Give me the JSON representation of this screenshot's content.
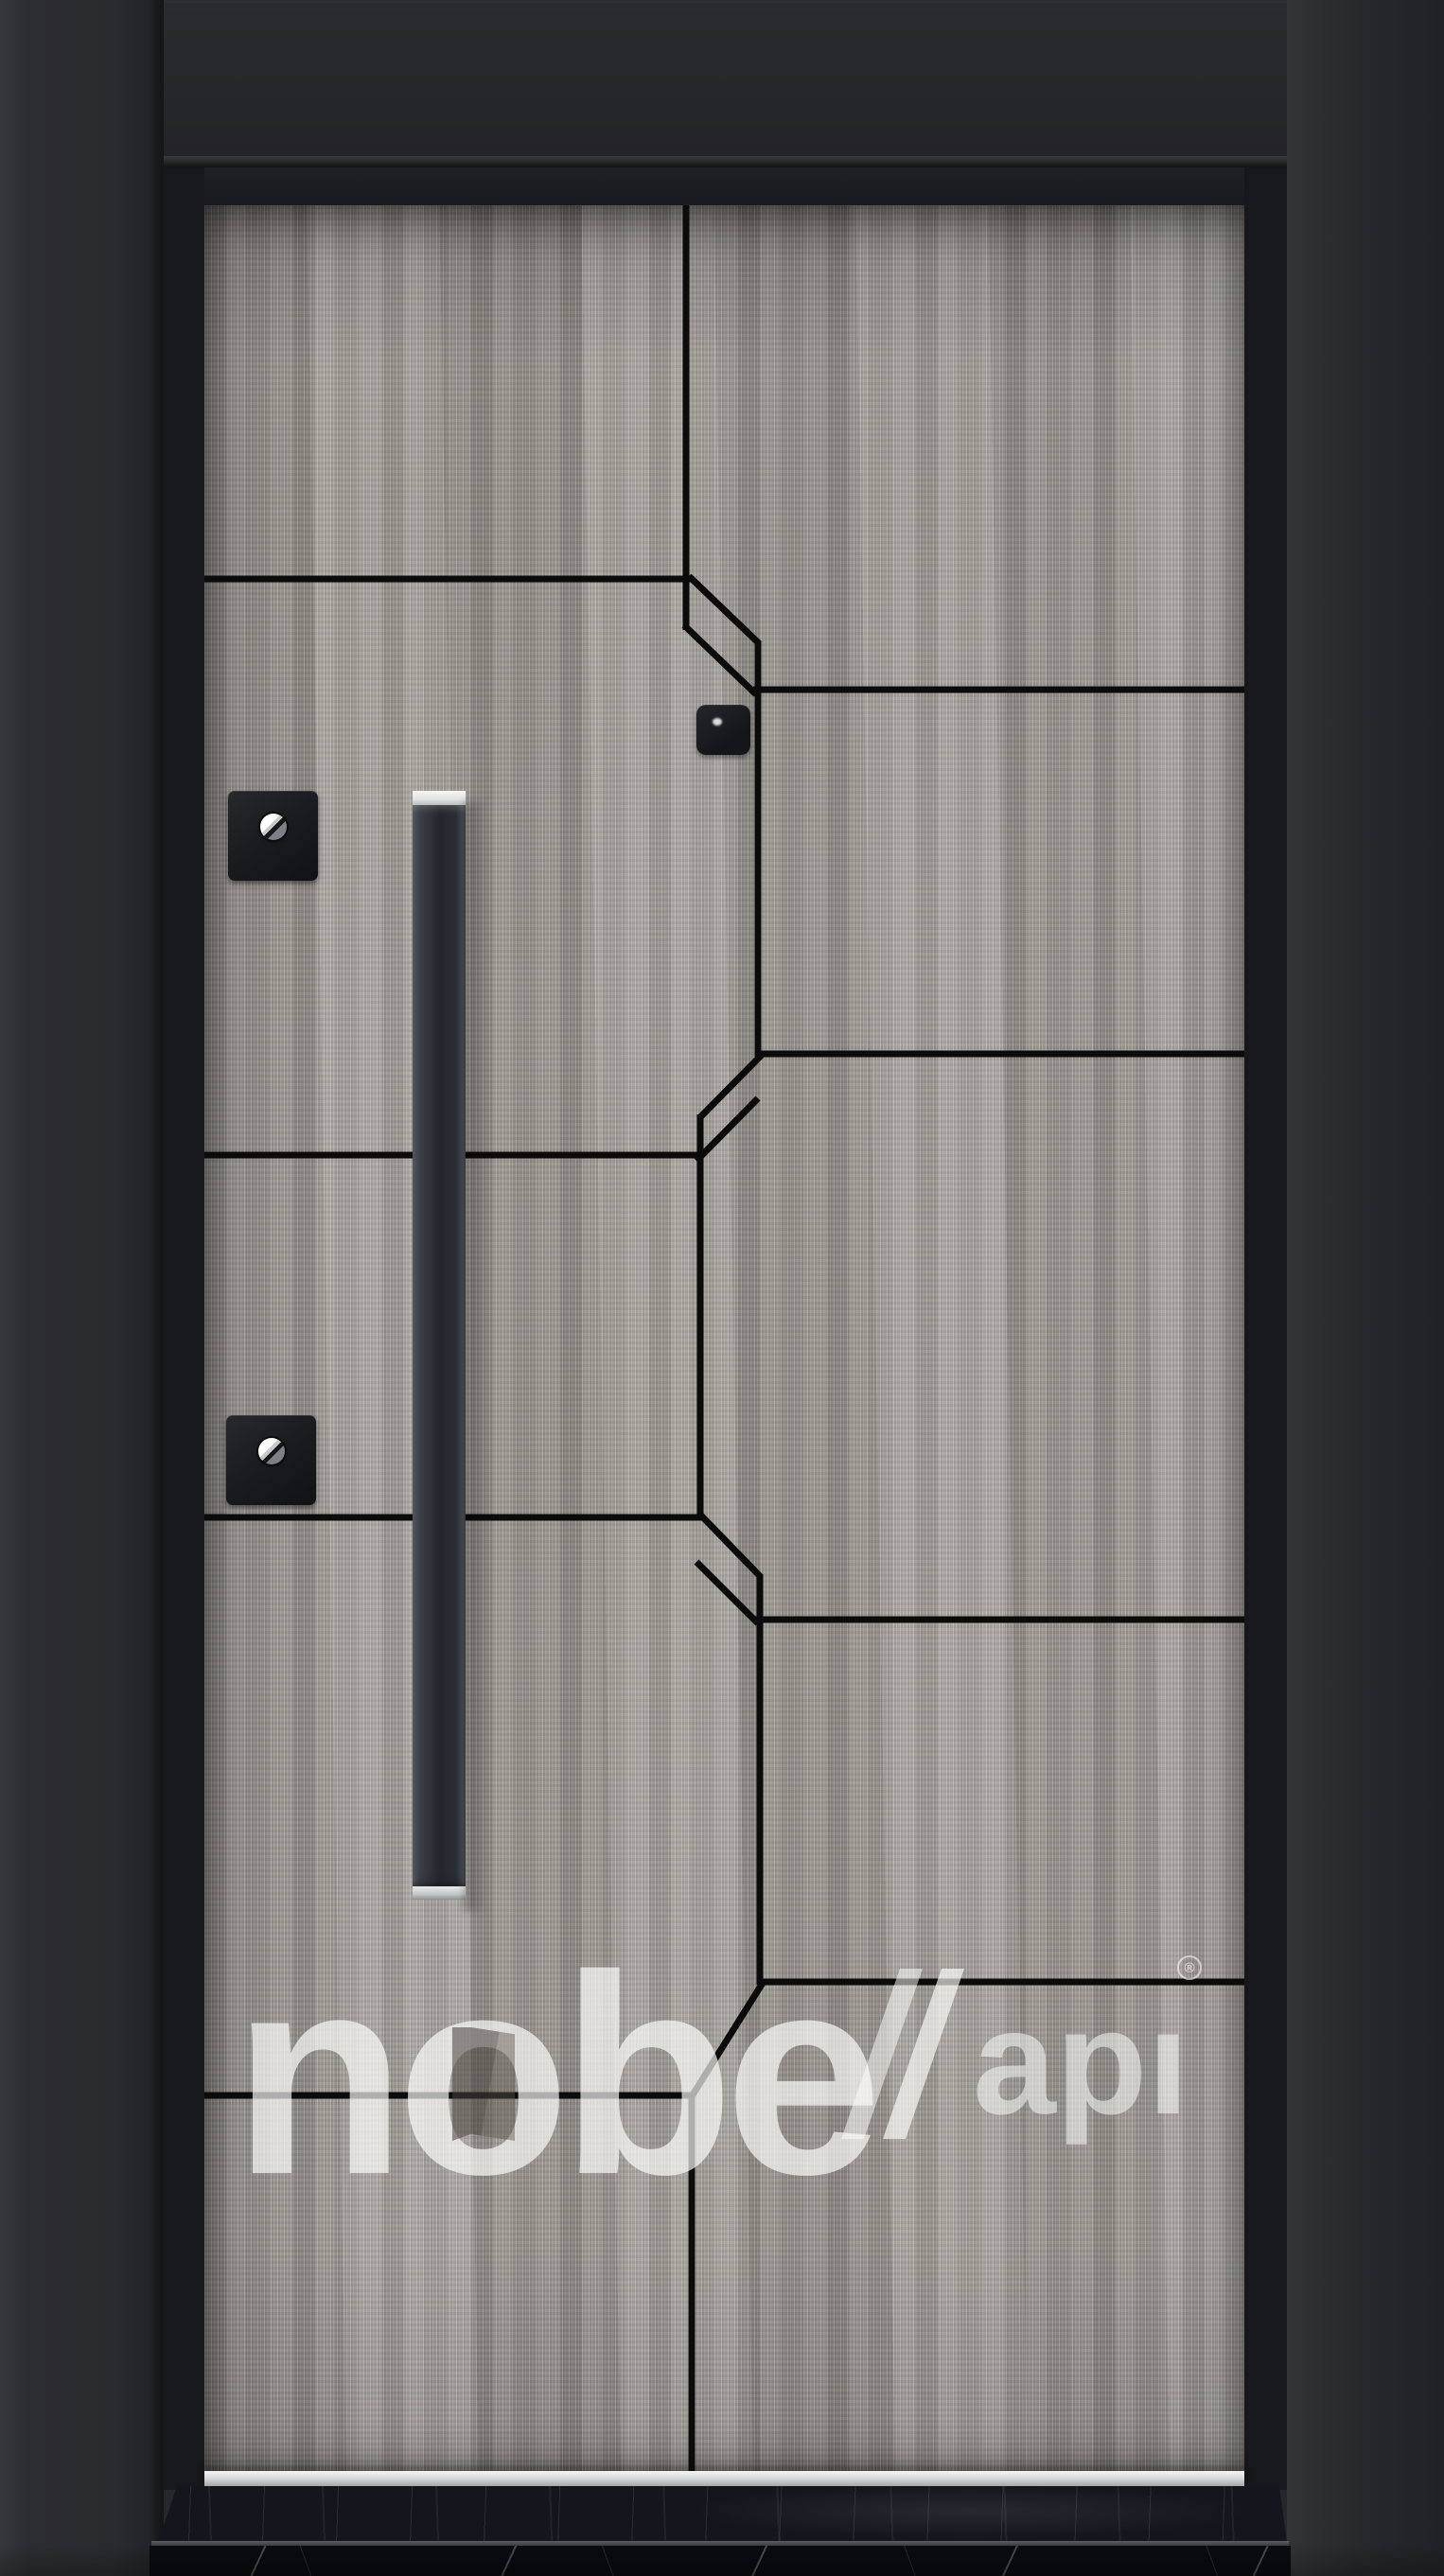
{
  "photo": {
    "subject": "Steel entry door product photo: grey wood-grain laminated leaf with black geometric groove lines, long black square pull handle, black frame with transom panel and black marble threshold",
    "watermark": {
      "full_brand": "nobel kapı",
      "primary_display": "nobe",
      "secondary_display": "apı",
      "registered": "®"
    },
    "hardware": [
      {
        "name": "vertical-pull-handle",
        "finish": "matte black with chrome end caps"
      },
      {
        "name": "upper-thumbturn-escutcheon",
        "finish": "matte black square, chrome turn"
      },
      {
        "name": "lower-thumbturn-escutcheon",
        "finish": "matte black square, chrome turn"
      },
      {
        "name": "cylinder-viewer",
        "finish": "black square with chrome lens"
      },
      {
        "name": "kick-plate",
        "finish": "brushed aluminum strip"
      }
    ],
    "colors": {
      "wood_base": "#a6a29c",
      "groove": "#0b0b0c",
      "frame_wall_left": "#2c2d30",
      "frame_wall_right": "#26272a",
      "transom": "#27282b",
      "jamb": "#17181b",
      "handle_body": "#2e3338",
      "chrome": "#e9eaea",
      "kick_strip": "#d9dbdb",
      "marble_top": "#15151d",
      "marble_face": "#0a0b10",
      "watermark_white": "rgba(255,255,255,0.68)"
    }
  }
}
